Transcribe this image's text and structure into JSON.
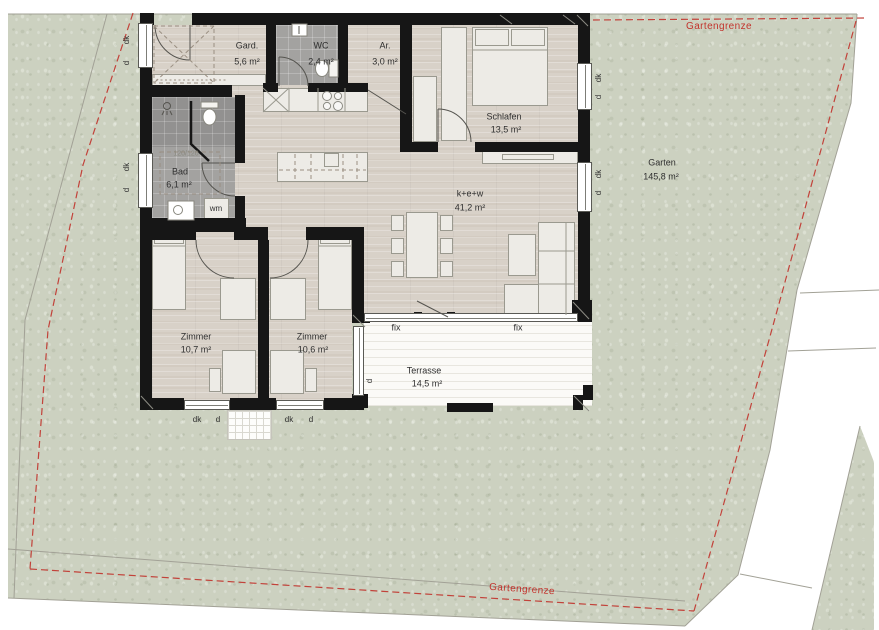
{
  "site": {
    "garden_name": "Garten",
    "garden_area": "145,8 m²",
    "boundary_label_top": "Gartengrenze",
    "boundary_label_bottom": "Gartengrenze"
  },
  "rooms": {
    "gard": {
      "name": "Gard.",
      "area": "5,6 m²"
    },
    "wc": {
      "name": "WC",
      "area": "2,4 m²"
    },
    "ar": {
      "name": "Ar.",
      "area": "3,0 m²"
    },
    "schlafen": {
      "name": "Schlafen",
      "area": "13,5 m²"
    },
    "bad": {
      "name": "Bad",
      "area": "6,1 m²"
    },
    "kew": {
      "name": "k+e+w",
      "area": "41,2 m²"
    },
    "zimmer1": {
      "name": "Zimmer",
      "area": "10,7 m²"
    },
    "zimmer2": {
      "name": "Zimmer",
      "area": "10,6 m²"
    },
    "terrasse": {
      "name": "Terrasse",
      "area": "14,5 m²"
    }
  },
  "annotations": {
    "fix": "fix",
    "dk": "dk",
    "d": "d",
    "wm": "wm",
    "shower_size": "120/120"
  },
  "colors": {
    "boundary_red": "#c2332c",
    "wall_black": "#161616",
    "garden_green": "#ccd1c0",
    "floor_wood": "#d8d1c8",
    "tile_gray": "#a3a2a0"
  }
}
